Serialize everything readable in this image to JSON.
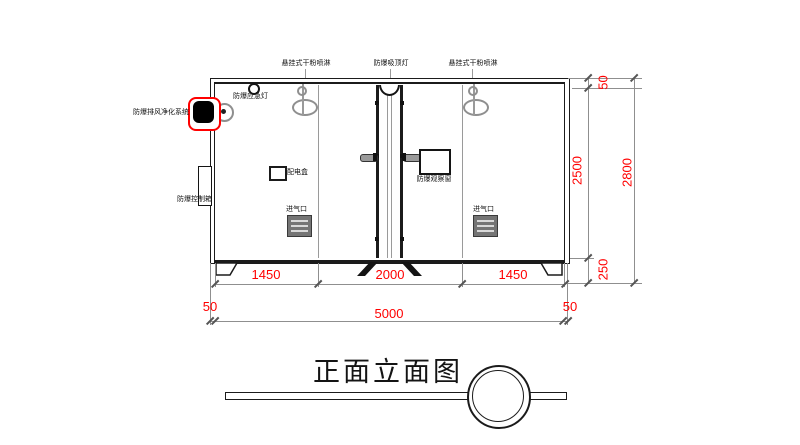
{
  "title": "正面立面图",
  "annotations": {
    "sprinkler_left": "悬挂式干粉喷淋",
    "ceiling_lamp": "防爆吸顶灯",
    "sprinkler_right": "悬挂式干粉喷淋",
    "emergency_lamp": "防爆应急灯",
    "purge_system": "防爆排风净化系统",
    "control_box": "防爆控制箱",
    "power_box": "配电盒",
    "observation_window": "防爆观察窗",
    "air_inlet_left": "进气口",
    "air_inlet_right": "进气口"
  },
  "dimensions": {
    "bottom_seg_left": "1450",
    "bottom_seg_mid": "2000",
    "bottom_seg_right": "1450",
    "bottom_wall_left": "50",
    "bottom_total": "5000",
    "bottom_wall_right": "50",
    "right_roof": "50",
    "right_body": "2500",
    "right_base": "250",
    "right_total": "2800"
  },
  "colors": {
    "dimension_text": "#ff0000",
    "highlight_outline": "#ff0000",
    "drawing_line": "#1b1b1b",
    "fixture_gray": "#8f8f8f",
    "vent_fill": "#757575"
  }
}
